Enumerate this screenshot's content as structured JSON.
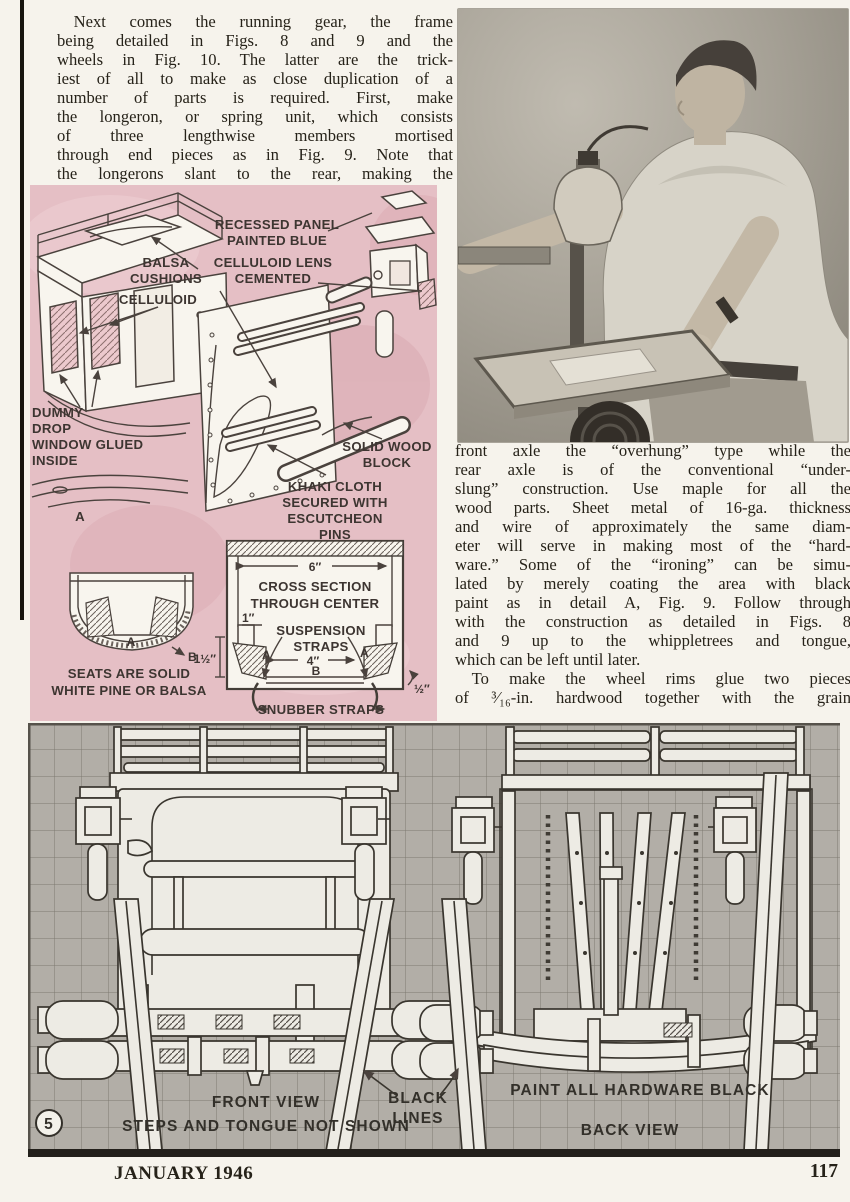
{
  "article": {
    "left": "  Next comes the running gear, the frame\nbeing detailed in Figs. 8 and 9 and the\nwheels in Fig. 10.  The latter are the trick-\niest of all to make as close duplication of a\nnumber of parts is required.  First, make\nthe longeron, or spring unit, which consists\nof three lengthwise members mortised\nthrough end pieces as in Fig. 9.  Note that\nthe longerons slant to the rear, making the",
    "right_a": "front axle the “overhung” type while the\nrear axle is of the conventional “under-\nslung” construction.  Use maple for all the\nwood parts.  Sheet metal of 16-ga. thickness\nand wire of approximately the same diam-\neter will serve in making most of the “hard-\nware.”  Some of the “ironing” can be simu-\nlated by merely coating the area with black\npaint as in detail A, Fig. 9.  Follow through\nwith the construction as detailed in Figs. 8\nand 9 up to the whippletrees and tongue,",
    "right_b": "which can be left until later.",
    "right_c": "  To make the wheel rims glue two pieces\nof ³⁄₁₆-in. hardwood together with the grain"
  },
  "pink": {
    "labels": {
      "balsa": [
        "BALSA",
        "CUSHIONS"
      ],
      "celluloid": "CELLULOID",
      "recessed": [
        "RECESSED PANEL",
        "PAINTED BLUE"
      ],
      "lens": [
        "CELLULOID LENS",
        "CEMENTED"
      ],
      "dummy": [
        "DUMMY",
        "DROP",
        "WINDOW GLUED",
        "INSIDE"
      ],
      "detail_a": "A",
      "solid_wood": [
        "SOLID WOOD",
        "BLOCK"
      ],
      "khaki": [
        "KHAKI CLOTH",
        "SECURED WITH",
        "ESCUTCHEON",
        "PINS"
      ],
      "seats": [
        "SEATS ARE SOLID",
        "WHITE PINE OR BALSA"
      ],
      "seat_a": "A",
      "seat_b": "B",
      "dim6": "6″",
      "cross": [
        "CROSS SECTION",
        "THROUGH CENTER"
      ],
      "dim1": "1″",
      "susp": [
        "SUSPENSION",
        "STRAPS"
      ],
      "a_left": "A",
      "a_right": "A",
      "dim15": "1½″",
      "dim4": "4″",
      "b": "B",
      "dimhalf": "½″",
      "snubber": "SNUBBER STRAPS"
    },
    "panel_color": "#e5bfc5"
  },
  "plan": {
    "labels": {
      "front_view": "FRONT VIEW",
      "steps": "STEPS AND TONGUE NOT SHOWN",
      "black": [
        "BLACK",
        "LINES"
      ],
      "paint": "PAINT ALL HARDWARE BLACK",
      "back_view": "BACK VIEW",
      "num": "5"
    },
    "grid_color": "#b2aea7"
  },
  "footer": {
    "date": "JANUARY 1946",
    "page": "117"
  }
}
